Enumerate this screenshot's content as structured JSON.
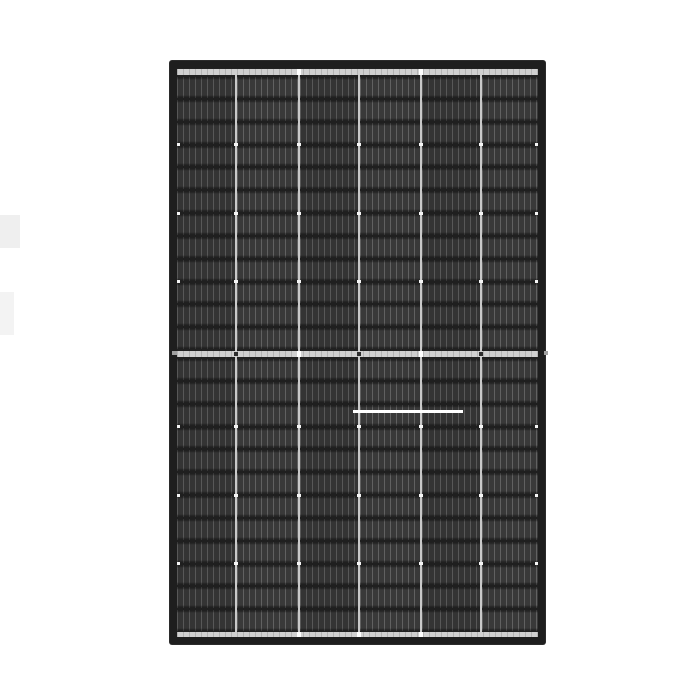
{
  "scene": {
    "type": "product-photo",
    "subject": "black-frame monocrystalline solar PV module, front view, white studio background",
    "background_color": "#ffffff"
  },
  "artifacts": [
    {
      "x": 0,
      "y": 215,
      "w": 20,
      "h": 33,
      "color": "#efefef"
    },
    {
      "x": 0,
      "y": 292,
      "w": 14,
      "h": 43,
      "color": "#f3f3f3"
    }
  ],
  "panel": {
    "geometry": {
      "x": 169,
      "y": 60,
      "width": 377,
      "height": 585,
      "frame_thickness": 8,
      "corner_radius": 3
    },
    "colors": {
      "frame": "#1e1e1e",
      "interior_background": "#212121",
      "row_gap": "#1f1f1f",
      "cell_base": "#343434",
      "cell_finger": "#585858",
      "cell_base_alt": "#393939",
      "cell_finger_alt": "#616161",
      "separator": "#c9c9c9",
      "rail": "#d0d0d0",
      "solder_dot": "#f5f5f5",
      "rail_dot_dark": "#2e2e2e",
      "rail_dot_light": "#ffffff",
      "frame_tick": "#a0a0a0"
    },
    "grid": {
      "columns": 6,
      "rows_per_half": 12,
      "column_widths": [
        58,
        61,
        58,
        60,
        58,
        56
      ],
      "column_gap": 2,
      "row_gap": 2
    },
    "separators": {
      "x_positions": [
        58,
        121,
        181,
        243,
        303
      ],
      "width": 2,
      "top": 7,
      "bottom": 569
    },
    "halves": [
      {
        "y": 9,
        "height": 272
      },
      {
        "y": 291,
        "height": 272
      }
    ],
    "rails": {
      "top": {
        "y": 1,
        "height": 6,
        "dots_light_x": [
          121,
          243
        ],
        "dots_dark_x": []
      },
      "middle": {
        "y": 283,
        "height": 6,
        "dots_light_x": [
          121,
          243
        ],
        "dots_dark_x": [
          58,
          181,
          303
        ]
      },
      "bottom": {
        "y": 564,
        "height": 5,
        "dots_light_x": [
          121,
          181,
          243
        ],
        "dots_dark_x": []
      }
    },
    "solder_dots": {
      "row_indices": [
        3,
        6,
        9
      ],
      "x_positions": [
        0,
        58,
        121,
        181,
        243,
        303,
        359
      ],
      "width": 4,
      "height": 3
    },
    "glare_line": {
      "x": 176,
      "y": 342,
      "width": 110,
      "height": 3,
      "color": "#ffffff"
    },
    "frame_ticks": [
      {
        "x": 3,
        "y": 291,
        "w": 5,
        "h": 4
      },
      {
        "x": 375,
        "y": 291,
        "w": 4,
        "h": 4
      }
    ]
  }
}
